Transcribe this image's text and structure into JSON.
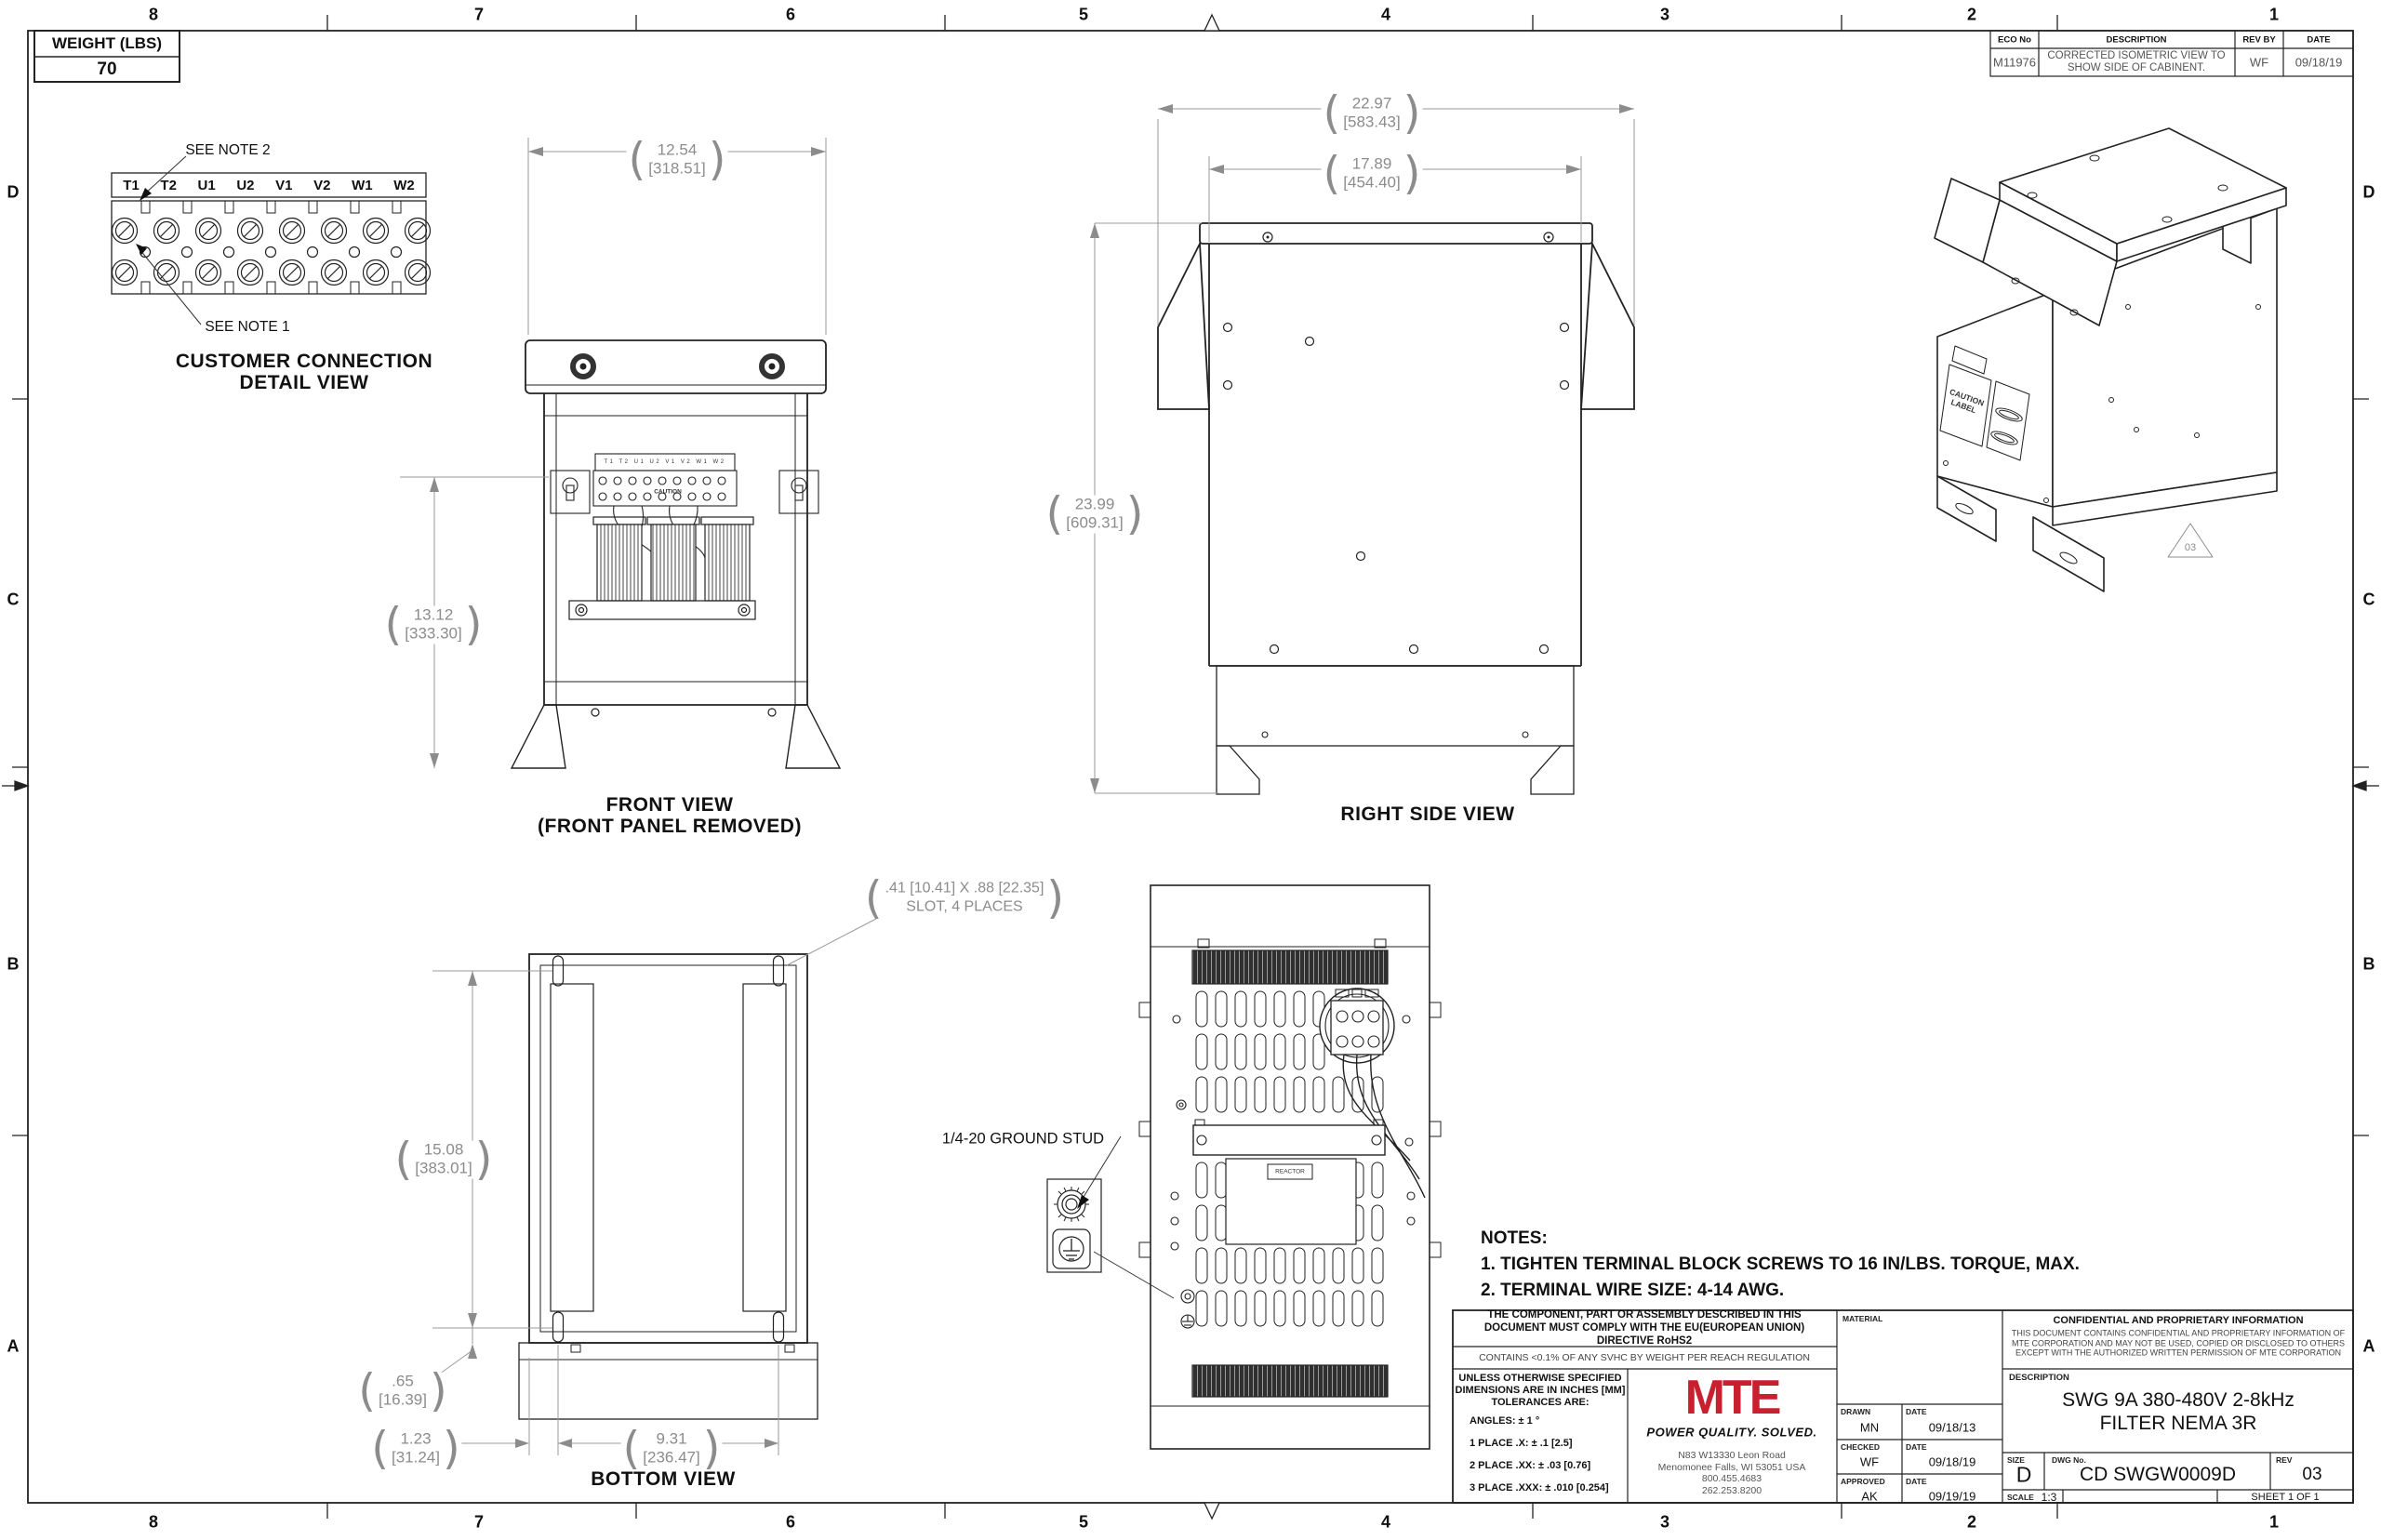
{
  "sheet": {
    "zone_cols": [
      "8",
      "7",
      "6",
      "5",
      "4",
      "3",
      "2",
      "1"
    ],
    "zone_rows": [
      "D",
      "C",
      "B",
      "A"
    ]
  },
  "weight_box": {
    "label": "WEIGHT (LBS)",
    "value": "70"
  },
  "eco_table": {
    "headers": [
      "ECO No",
      "DESCRIPTION",
      "REV BY",
      "DATE"
    ],
    "eco_no": "M11976",
    "description": "CORRECTED ISOMETRIC VIEW TO SHOW SIDE OF CABINENT.",
    "rev_by": "WF",
    "date": "09/18/19"
  },
  "detail_view": {
    "terminals": [
      "T1",
      "T2",
      "U1",
      "U2",
      "V1",
      "V2",
      "W1",
      "W2"
    ],
    "note2": "SEE NOTE 2",
    "note1": "SEE NOTE 1",
    "title1": "CUSTOMER CONNECTION",
    "title2": "DETAIL VIEW"
  },
  "front_view": {
    "dim_width_in": "12.54",
    "dim_width_mm": "[318.51]",
    "dim_height_in": "13.12",
    "dim_height_mm": "[333.30]",
    "terminals_row": "T1 T2 U1 U2 V1 V2 W1 W2",
    "caution": "CAUTION",
    "label1": "FRONT VIEW",
    "label2": "(FRONT PANEL REMOVED)"
  },
  "right_side_view": {
    "dim1_in": "22.97",
    "dim1_mm": "[583.43]",
    "dim2_in": "17.89",
    "dim2_mm": "[454.40]",
    "dim3_in": "23.99",
    "dim3_mm": "[609.31]",
    "label": "RIGHT SIDE VIEW"
  },
  "iso_view": {
    "caution_line1": "CAUTION",
    "caution_line2": "LABEL",
    "rev_flag": "03"
  },
  "bottom_view": {
    "slot_note1": ".41 [10.41] X .88 [22.35]",
    "slot_note2": "SLOT, 4 PLACES",
    "dim_h_in": "15.08",
    "dim_h_mm": "[383.01]",
    "dim_off_in": ".65",
    "dim_off_mm": "[16.39]",
    "dim_side_in": "1.23",
    "dim_side_mm": "[31.24]",
    "dim_w_in": "9.31",
    "dim_w_mm": "[236.47]",
    "label": "BOTTOM VIEW"
  },
  "internal_view": {
    "ground_stud": "1/4-20 GROUND STUD",
    "reactor_label": "REACTOR"
  },
  "notes": {
    "title": "NOTES:",
    "items": [
      "1.  TIGHTEN TERMINAL BLOCK SCREWS TO 16 IN/LBS. TORQUE, MAX.",
      "2.  TERMINAL WIRE SIZE: 4-14 AWG."
    ]
  },
  "title_block": {
    "compliance1": "THE COMPONENT, PART OR ASSEMBLY DESCRIBED IN THIS DOCUMENT MUST COMPLY WITH THE EU(EUROPEAN UNION) DIRECTIVE RoHS2",
    "compliance2": "CONTAINS <0.1% OF ANY SVHC BY WEIGHT PER REACH REGULATION",
    "tol_line1": "UNLESS OTHERWISE SPECIFIED",
    "tol_line2": "DIMENSIONS ARE IN INCHES [MM]",
    "tol_line3": "TOLERANCES ARE:",
    "tol_angles": "ANGLES: ± 1 °",
    "tol_place1": "1 PLACE .X: ± .1 [2.5]",
    "tol_place2": "2 PLACE .XX: ± .03 [0.76]",
    "tol_place3": "3 PLACE .XXX: ± .010 [0.254]",
    "brand_logo": "MTE",
    "brand_tagline": "POWER QUALITY. SOLVED.",
    "brand_addr1": "N83 W13330 Leon Road",
    "brand_addr2": "Menomonee Falls, WI 53051 USA",
    "brand_addr3": "800.455.4683",
    "brand_addr4": "262.253.8200",
    "brand_color": "#c8202f",
    "material_label": "MATERIAL",
    "signoff": [
      {
        "role": "DRAWN",
        "name": "MN",
        "date_label": "DATE",
        "date": "09/18/13"
      },
      {
        "role": "CHECKED",
        "name": "WF",
        "date_label": "DATE",
        "date": "09/18/19"
      },
      {
        "role": "APPROVED",
        "name": "AK",
        "date_label": "DATE",
        "date": "09/19/19"
      }
    ],
    "confidential_title": "CONFIDENTIAL AND PROPRIETARY INFORMATION",
    "confidential_body": "THIS DOCUMENT CONTAINS CONFIDENTIAL AND PROPRIETARY INFORMATION OF MTE CORPORATION AND MAY NOT BE USED, COPIED OR DISCLOSED TO OTHERS EXCEPT WITH THE AUTHORIZED WRITTEN PERMISSION OF MTE CORPORATION",
    "description_label": "DESCRIPTION",
    "description": "SWG 9A 380-480V 2-8kHz FILTER NEMA 3R",
    "size_label": "SIZE",
    "size": "D",
    "dwg_label": "DWG No.",
    "dwg_no": "CD SWGW0009D",
    "rev_label": "REV",
    "rev": "03",
    "scale_label": "SCALE",
    "scale": "1:3",
    "sheet_text": "SHEET 1  OF 1"
  }
}
